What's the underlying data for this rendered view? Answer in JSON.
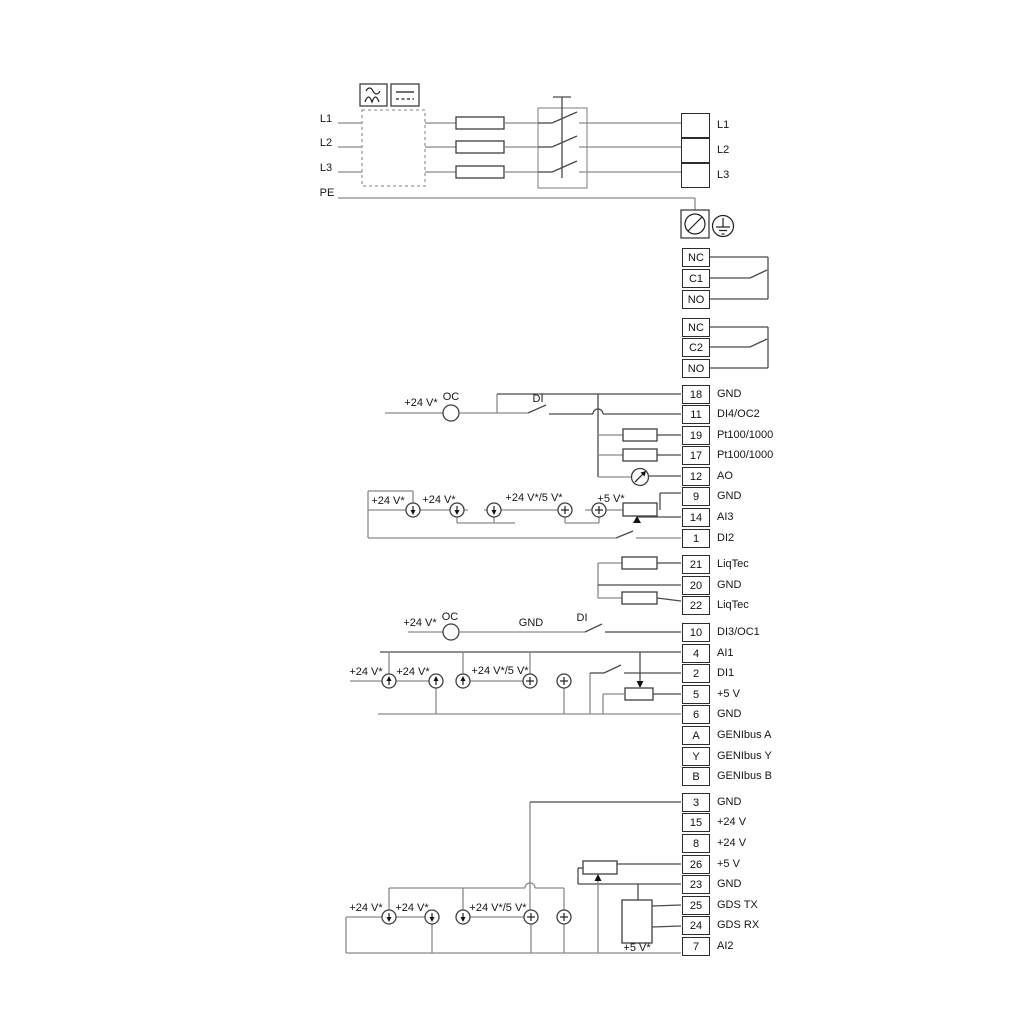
{
  "mains": {
    "in_l1": "L1",
    "in_l2": "L2",
    "in_l3": "L3",
    "pe": "PE",
    "out_l1": "L1",
    "out_l2": "L2",
    "out_l3": "L3"
  },
  "wire_labels": {
    "v24": "+24 V*",
    "v24_5": "+24 V*/5 V*",
    "v5": "+5 V*",
    "oc": "OC",
    "di": "DI",
    "gnd": "GND"
  },
  "terminals": [
    {
      "pin": "NC",
      "label": ""
    },
    {
      "pin": "C1",
      "label": ""
    },
    {
      "pin": "NO",
      "label": ""
    },
    {
      "pin": "NC",
      "label": ""
    },
    {
      "pin": "C2",
      "label": ""
    },
    {
      "pin": "NO",
      "label": ""
    },
    {
      "pin": "18",
      "label": "GND"
    },
    {
      "pin": "11",
      "label": "DI4/OC2"
    },
    {
      "pin": "19",
      "label": "Pt100/1000"
    },
    {
      "pin": "17",
      "label": "Pt100/1000"
    },
    {
      "pin": "12",
      "label": "AO"
    },
    {
      "pin": "9",
      "label": "GND"
    },
    {
      "pin": "14",
      "label": "AI3"
    },
    {
      "pin": "1",
      "label": "DI2"
    },
    {
      "pin": "21",
      "label": "LiqTec"
    },
    {
      "pin": "20",
      "label": "GND"
    },
    {
      "pin": "22",
      "label": "LiqTec"
    },
    {
      "pin": "10",
      "label": "DI3/OC1"
    },
    {
      "pin": "4",
      "label": "AI1"
    },
    {
      "pin": "2",
      "label": "DI1"
    },
    {
      "pin": "5",
      "label": "+5 V"
    },
    {
      "pin": "6",
      "label": "GND"
    },
    {
      "pin": "A",
      "label": "GENIbus A"
    },
    {
      "pin": "Y",
      "label": "GENIbus Y"
    },
    {
      "pin": "B",
      "label": "GENIbus B"
    },
    {
      "pin": "3",
      "label": "GND"
    },
    {
      "pin": "15",
      "label": "+24 V"
    },
    {
      "pin": "8",
      "label": "+24 V"
    },
    {
      "pin": "26",
      "label": "+5 V"
    },
    {
      "pin": "23",
      "label": "GND"
    },
    {
      "pin": "25",
      "label": "GDS TX"
    },
    {
      "pin": "24",
      "label": "GDS RX"
    },
    {
      "pin": "7",
      "label": "AI2"
    }
  ]
}
